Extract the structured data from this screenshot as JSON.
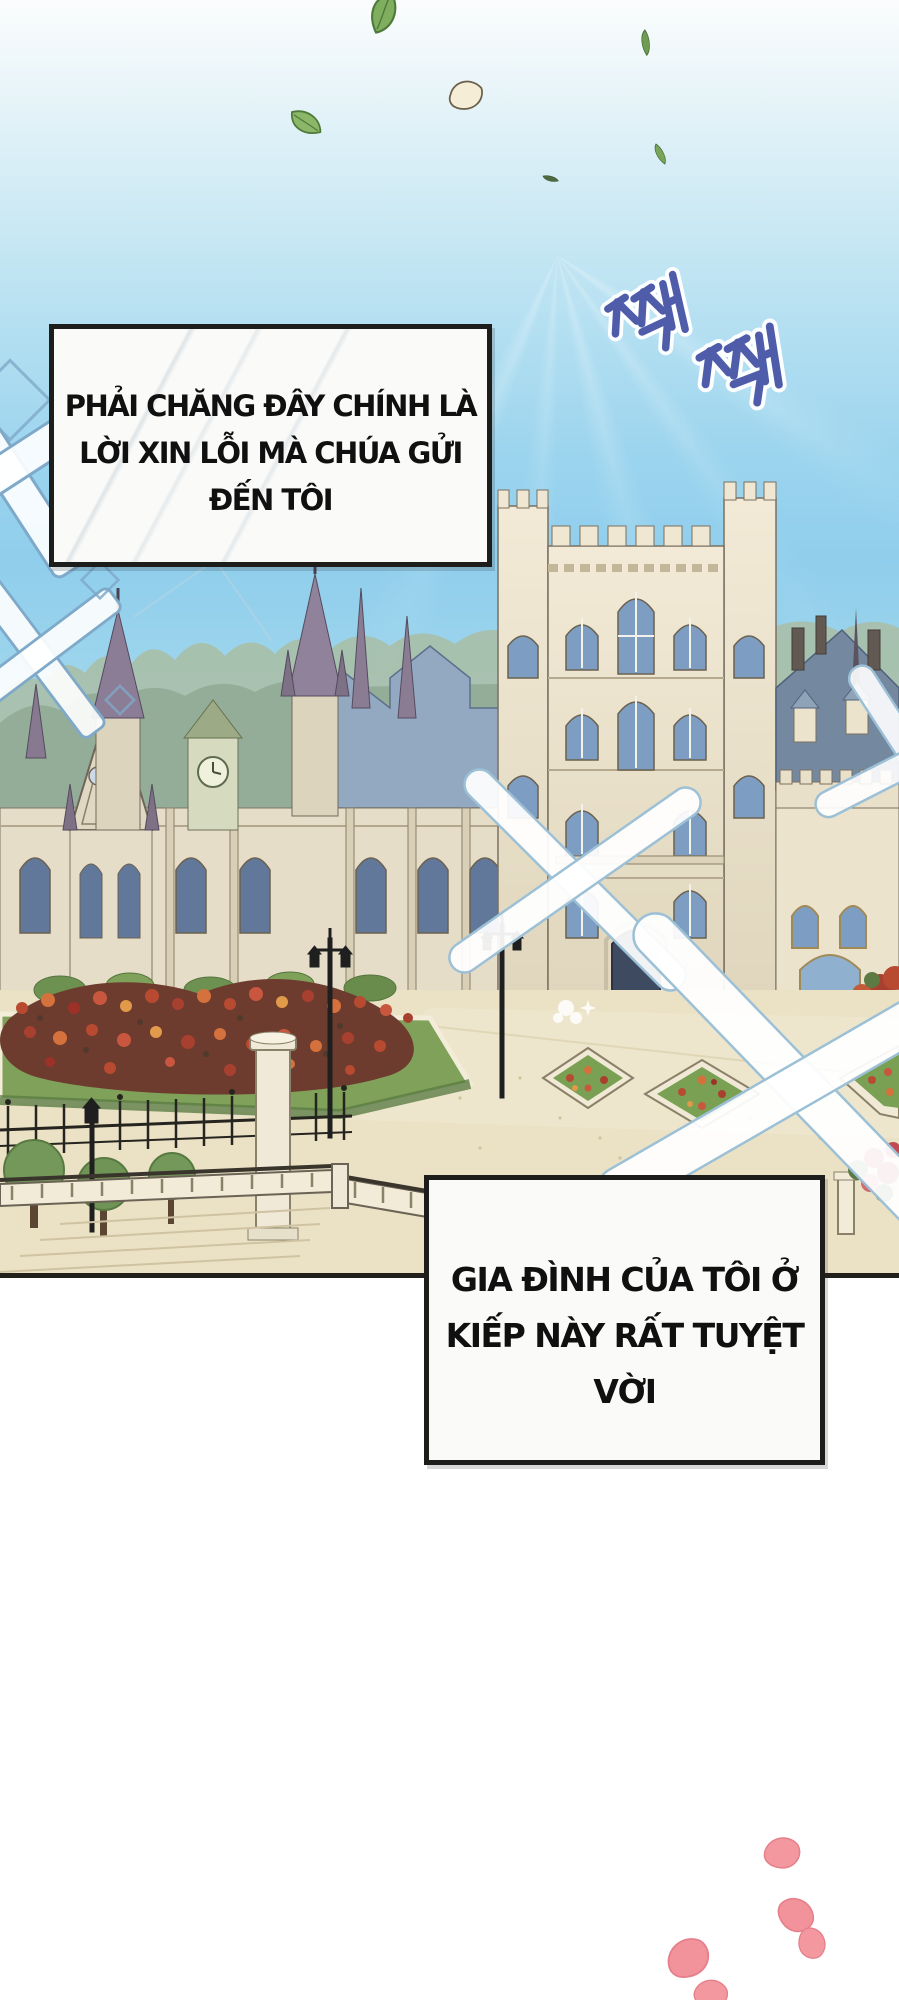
{
  "speech_boxes": [
    {
      "name": "speech-box-1",
      "lines": [
        "PHẢI CHĂNG ĐÂY CHÍNH LÀ",
        "LỜI XIN LỖI MÀ CHÚA GỬI",
        "ĐẾN TÔI"
      ]
    },
    {
      "name": "speech-box-2",
      "lines": [
        "GIA ĐÌNH CỦA TÔI Ở",
        "KIẾP NÀY RẤT TUYỆT",
        "VỜI"
      ]
    }
  ],
  "sfx": {
    "text": "짹 짹"
  },
  "decor_icons": [
    "falling-leaf-icon",
    "cream-petal-icon",
    "sparkle-x-icon",
    "lattice-x-icon",
    "pink-petal-icon"
  ],
  "colors": {
    "sky_top": "#fbfdfd",
    "sky_mid": "#8fceec",
    "box_background": "#fafaf8",
    "box_border": "#1d1d1b",
    "speech_text": "#101010",
    "sfx_blue": "#4e5caa",
    "leaf_green": "#7fae5e",
    "petal_pink": "#f4989f",
    "sparkle_outline": "#9cc0d6",
    "castle_wall": "#ece4cf",
    "roof_blue": "#74889f",
    "garden_green": "#7fa159",
    "ground_tan": "#ebe2c6"
  }
}
